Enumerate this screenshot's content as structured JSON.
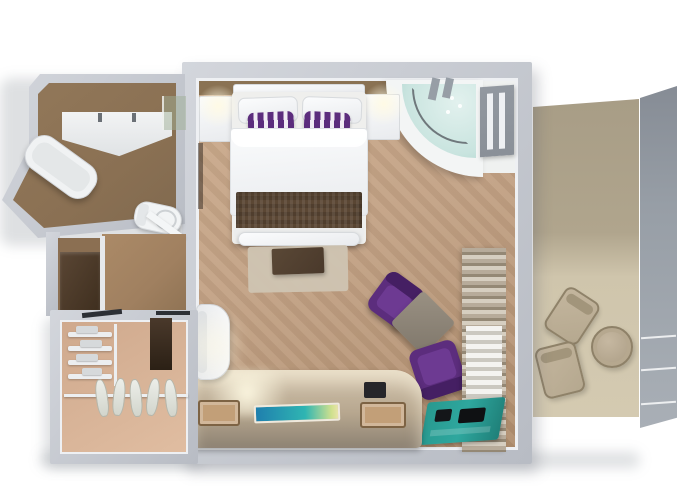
{
  "scene": {
    "label": "3D rendered top-down floor plan of a suite",
    "background": "#ffffff"
  },
  "palette": {
    "wall": "#b8bcc4",
    "wall_light": "#d3d6dc",
    "inner_face": "#eef0f3",
    "carpet": "#c2a184",
    "carpet_dark": "#b08e6e",
    "bath_floor": "#8a7053",
    "entry_floor": "#a08060",
    "closet_floor": "#cfa98d",
    "balcony_wall": "#a89d86",
    "balcony_floor": "#d4cab1",
    "railing": "#979ea6",
    "white_furniture": "#f3f4f6",
    "dark_wood": "#4a392b",
    "runner_brown": "#5b4734",
    "accent_purple": "#5c2d7d",
    "accent_purple_light": "#6d3a92",
    "jacuzzi_water": "#c9e4df",
    "tv_blue": "#1f7fae",
    "tv_teal": "#2fb5b2",
    "mat_teal": "#28998f",
    "stool_tan": "#c29f78",
    "chair_tan": "#b5a88f"
  },
  "rooms": {
    "bedroom": {
      "name": "Bedroom",
      "furniture": [
        "king-bed",
        "headboard",
        "nightstand-left",
        "nightstand-right",
        "bed-runner",
        "bench",
        "rug",
        "coffee-table",
        "jacuzzi-tub",
        "armchair-upper",
        "armchair-lower",
        "side-table",
        "curtains",
        "luggage-mat",
        "desk-console",
        "tv-screen",
        "stool-left",
        "stool-right",
        "desk-chair",
        "balcony-door"
      ]
    },
    "bathroom": {
      "name": "Bathroom",
      "furniture": [
        "vanity-counter",
        "bathtub",
        "toilet",
        "shower-screen",
        "door-leaf"
      ]
    },
    "closet": {
      "name": "Walk-in Closet",
      "furniture": [
        "shelves",
        "hanging-rail",
        "garments",
        "mirror-panel",
        "cabinet"
      ]
    },
    "balcony": {
      "name": "Balcony",
      "furniture": [
        "privacy-partition",
        "glass-railing",
        "round-table",
        "lounge-chair-1",
        "lounge-chair-2"
      ]
    }
  }
}
